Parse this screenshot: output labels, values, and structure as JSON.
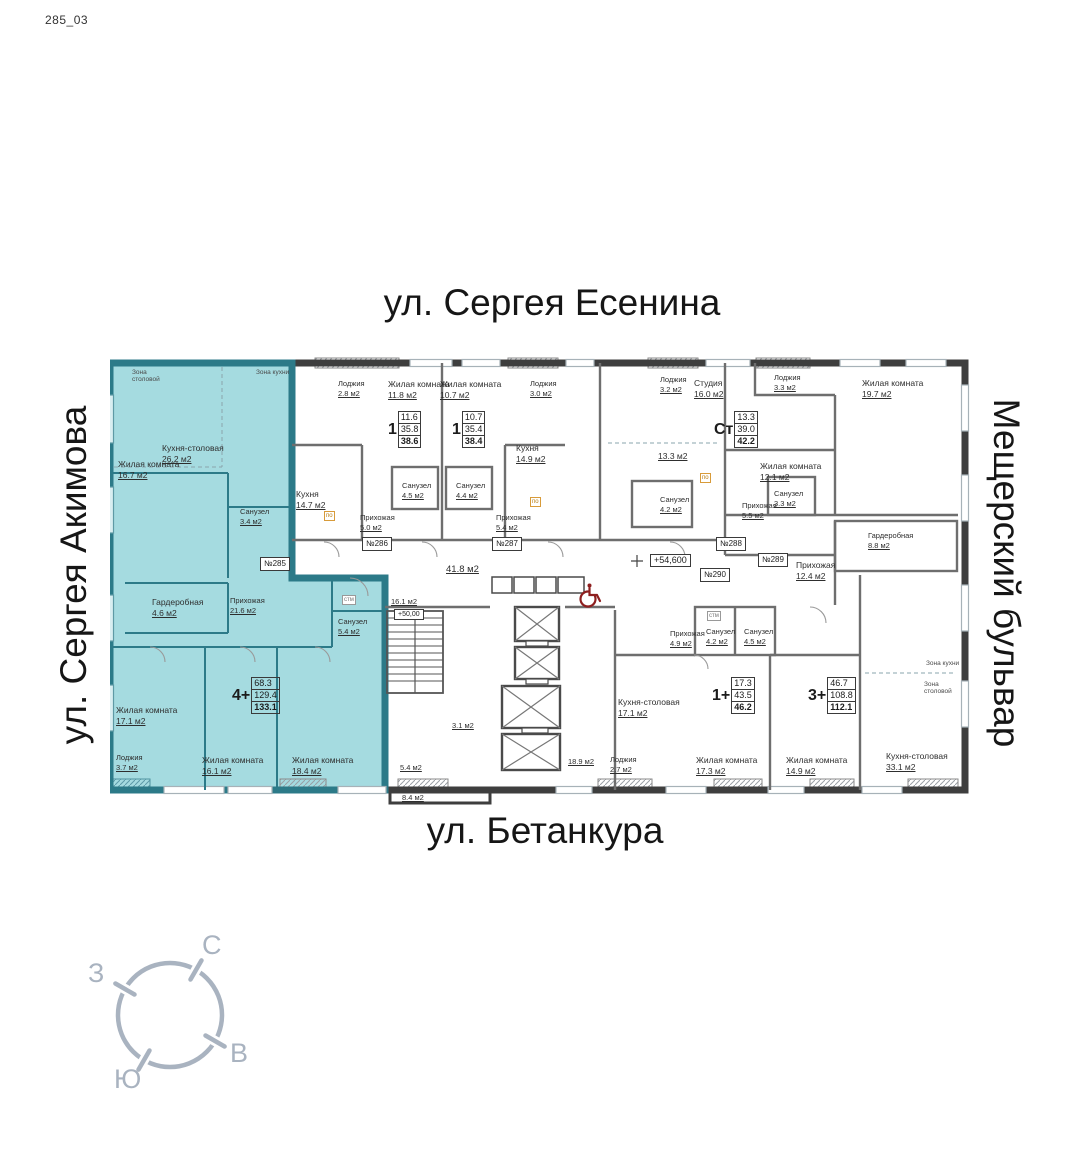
{
  "sheet": {
    "code": "285_03"
  },
  "streets": {
    "top": "ул. Сергея Есенина",
    "left": "ул. Сергея Акимова",
    "right": "Мещерский бульвар",
    "bottom": "ул. Бетанкура"
  },
  "compass": {
    "north": "С",
    "south": "Ю",
    "west": "З",
    "east": "В"
  },
  "legend": {
    "elevation": "+54,600",
    "stair_elevation": "+50,00"
  },
  "highlight_color": "#a5dbe0",
  "apartments": [
    {
      "number": "№285",
      "type": "4+",
      "living_area": "68.3",
      "area": "129.4",
      "total_area": "133.1",
      "highlighted": true
    },
    {
      "number": "№286",
      "type": "1",
      "living_area": "11.6",
      "area": "35.8",
      "total_area": "38.6",
      "highlighted": false
    },
    {
      "number": "№287",
      "type": "1",
      "living_area": "10.7",
      "area": "35.4",
      "total_area": "38.4",
      "highlighted": false
    },
    {
      "number": "№288",
      "type": "Ст",
      "living_area": "13.3",
      "area": "39.0",
      "total_area": "42.2",
      "highlighted": false
    },
    {
      "number": "№289",
      "type": "3+",
      "living_area": "46.7",
      "area": "108.8",
      "total_area": "112.1",
      "highlighted": false
    },
    {
      "number": "№290",
      "type": "1+",
      "living_area": "17.3",
      "area": "43.5",
      "total_area": "46.2",
      "highlighted": false
    }
  ],
  "markers": {
    "dishwasher": "по",
    "washer": "стм"
  },
  "rooms": [
    {
      "n": "Зона столовой",
      "a": ""
    },
    {
      "n": "Зона кухни",
      "a": ""
    },
    {
      "n": "Кухня-столовая",
      "a": "26.2 м2"
    },
    {
      "n": "Жилая комната",
      "a": "16.7 м2"
    },
    {
      "n": "Санузел",
      "a": "3.4 м2"
    },
    {
      "n": "Гардеробная",
      "a": "4.6 м2"
    },
    {
      "n": "Прихожая",
      "a": "21.6 м2"
    },
    {
      "n": "Санузел",
      "a": "5.4 м2"
    },
    {
      "n": "Жилая комната",
      "a": "17.1 м2"
    },
    {
      "n": "Лоджия",
      "a": "3.7 м2"
    },
    {
      "n": "Жилая комната",
      "a": "16.1 м2"
    },
    {
      "n": "Жилая комната",
      "a": "18.4 м2"
    },
    {
      "n": "Лоджия",
      "a": "2.8 м2"
    },
    {
      "n": "Жилая комната",
      "a": "11.8 м2"
    },
    {
      "n": "Кухня",
      "a": "14.7 м2"
    },
    {
      "n": "Санузел",
      "a": "4.5 м2"
    },
    {
      "n": "Прихожая",
      "a": "5.0 м2"
    },
    {
      "n": "Жилая комната",
      "a": "10.7 м2"
    },
    {
      "n": "Лоджия",
      "a": "3.0 м2"
    },
    {
      "n": "Кухня",
      "a": "14.9 м2"
    },
    {
      "n": "Санузел",
      "a": "4.4 м2"
    },
    {
      "n": "Прихожая",
      "a": "5.4 м2"
    },
    {
      "n": "Лоджия",
      "a": "3.2 м2"
    },
    {
      "n": "Студия",
      "a": "16.0 м2"
    },
    {
      "n": "",
      "a": "13.3 м2"
    },
    {
      "n": "Санузел",
      "a": "4.2 м2"
    },
    {
      "n": "Прихожая",
      "a": "5.5 м2"
    },
    {
      "n": "Лоджия",
      "a": "3.3 м2"
    },
    {
      "n": "Жилая комната",
      "a": "19.7 м2"
    },
    {
      "n": "Жилая комната",
      "a": "12.1 м2"
    },
    {
      "n": "Санузел",
      "a": "3.3 м2"
    },
    {
      "n": "Гардеробная",
      "a": "8.8 м2"
    },
    {
      "n": "Прихожая",
      "a": "12.4 м2"
    },
    {
      "n": "Санузел",
      "a": "4.5 м2"
    },
    {
      "n": "Жилая комната",
      "a": "14.9 м2"
    },
    {
      "n": "Зона кухни",
      "a": ""
    },
    {
      "n": "Зона столовой",
      "a": ""
    },
    {
      "n": "Кухня-столовая",
      "a": "33.1 м2"
    },
    {
      "n": "Прихожая",
      "a": "4.9 м2"
    },
    {
      "n": "Санузел",
      "a": "4.2 м2"
    },
    {
      "n": "Кухня-столовая",
      "a": "17.1 м2"
    },
    {
      "n": "Лоджия",
      "a": "2.7 м2"
    },
    {
      "n": "Жилая комната",
      "a": "17.3 м2"
    },
    {
      "n": "",
      "a": "41.8 м2"
    },
    {
      "n": "",
      "a": "16.1 м2"
    },
    {
      "n": "",
      "a": "18.9 м2"
    },
    {
      "n": "",
      "a": "5.4 м2"
    },
    {
      "n": "",
      "a": "3.1 м2"
    },
    {
      "n": "",
      "a": "8.4 м2"
    }
  ]
}
